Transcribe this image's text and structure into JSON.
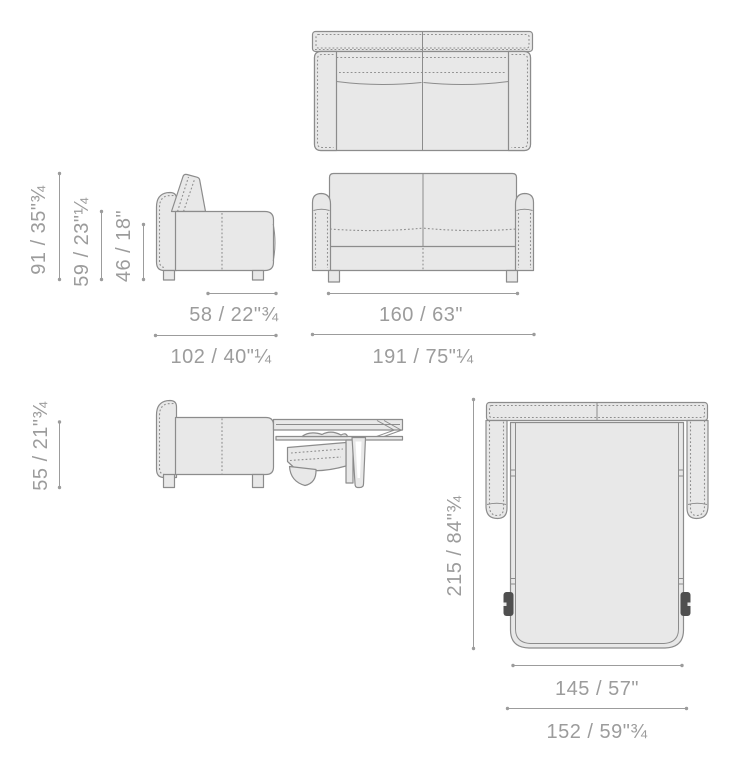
{
  "dims_closed": {
    "total_height": "91 / 35\"¾",
    "backrest_height": "59 / 23\"¼",
    "seat_height": "46 / 18\"",
    "seat_depth": "58 / 22\"¾",
    "total_depth": "102 / 40\"¼",
    "inner_width": "160 / 63\"",
    "total_width": "191 / 75\"¼"
  },
  "dims_open": {
    "bed_surface_height": "55 / 21\"¾",
    "open_length": "215 / 84\"¾",
    "mattress_width": "145 / 57\"",
    "bed_frame_width": "152 / 59\"¾"
  },
  "colors": {
    "background": "#ffffff",
    "body_fill": "#e8e8e8",
    "outline": "#8c8c8c",
    "stitch": "#8f8f8f",
    "dimension": "#9c9c9c",
    "text": "#9c9c9c",
    "wheel": "#4f4f4f"
  }
}
